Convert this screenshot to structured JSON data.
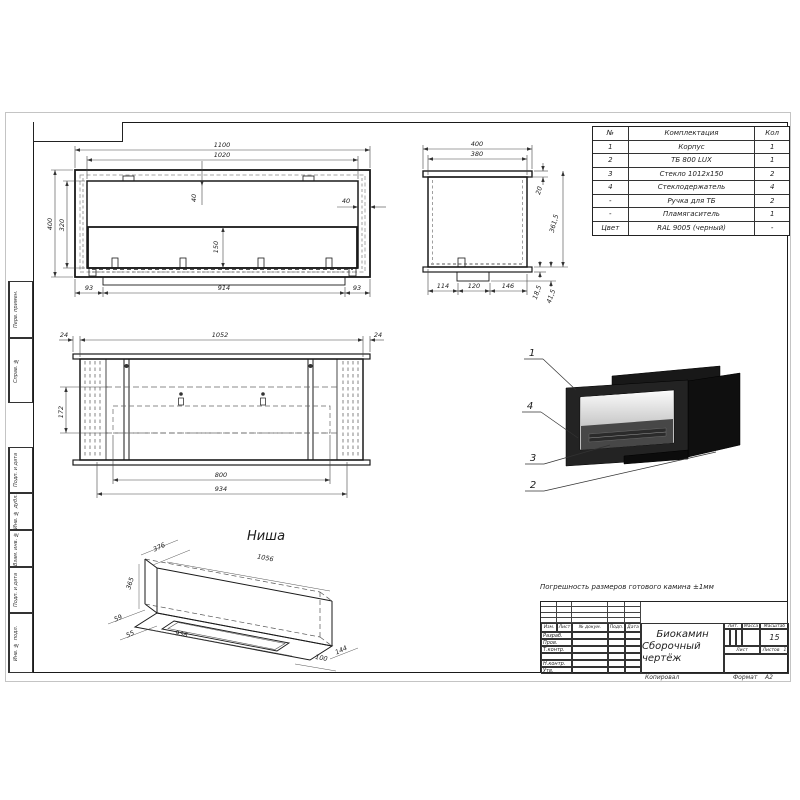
{
  "sheet": {
    "tolerance_note": "Погрешность размеров готового камина ±1мм",
    "copied_label": "Копировал",
    "format_label": "Формат",
    "format_value": "А2"
  },
  "margin": {
    "top_cells": [
      "Перв. примен.",
      "Справ. №"
    ],
    "bottom_cells": [
      "Подп. и дата",
      "Инв. № дубл.",
      "Взам. инв. №",
      "Подп. и дата",
      "Инв. № подл."
    ]
  },
  "parts_table": {
    "headers": {
      "num": "№",
      "name": "Комплектация",
      "qty": "Кол"
    },
    "rows": [
      {
        "num": "1",
        "name": "Корпус",
        "qty": "1"
      },
      {
        "num": "2",
        "name": "ТБ 800 LUX",
        "qty": "1"
      },
      {
        "num": "3",
        "name": "Стекло 1012х150",
        "qty": "2"
      },
      {
        "num": "4",
        "name": "Стеклодержатель",
        "qty": "4"
      },
      {
        "num": "-",
        "name": "Ручка для ТБ",
        "qty": "2"
      },
      {
        "num": "-",
        "name": "Пламягаситель",
        "qty": "1"
      },
      {
        "num": "Цвет",
        "name": "RAL 9005 (черный)",
        "qty": "-"
      }
    ]
  },
  "title_block": {
    "header_cols": [
      "Изм.",
      "Лист",
      "№ докум.",
      "Подп.",
      "Дата"
    ],
    "sig_rows": [
      "Разраб.",
      "Пров.",
      "Т.контр.",
      "",
      "Н.контр.",
      "Утв."
    ],
    "title_line1": "Биокамин",
    "title_line2": "Сборочный чертёж",
    "lit_label": "Лит.",
    "mass_label": "Масса",
    "scale_label": "Масштаб",
    "scale_value": "15",
    "sheet_label": "Лист",
    "sheets_label": "Листов",
    "sheets_value": "1"
  },
  "views": {
    "front": {
      "dims": {
        "w1100": "1100",
        "w1020": "1020",
        "h400": "400",
        "h320": "320",
        "d40a": "40",
        "d40b": "40",
        "d150": "150",
        "b93l": "93",
        "b914": "914",
        "b93r": "93"
      }
    },
    "side": {
      "dims": {
        "w400": "400",
        "w380": "380",
        "d20": "20",
        "h3615": "361,5",
        "b114": "114",
        "b120": "120",
        "b146": "146",
        "d185": "18,5",
        "d415": "41,5"
      }
    },
    "plan": {
      "dims": {
        "t24l": "24",
        "t1052": "1052",
        "t24r": "24",
        "l172": "172",
        "b800": "800",
        "b934": "934"
      }
    },
    "niche": {
      "title": "Ниша",
      "dims": {
        "d376": "376",
        "d1056": "1056",
        "d365": "365",
        "d59": "59",
        "d55": "55",
        "d938": "938",
        "d100": "100",
        "d144": "144"
      }
    },
    "iso": {
      "callouts": [
        "1",
        "4",
        "3",
        "2"
      ]
    }
  },
  "colors": {
    "line": "#1a1a1a",
    "dim_line": "#444",
    "body_black": "#1e1e1e"
  }
}
